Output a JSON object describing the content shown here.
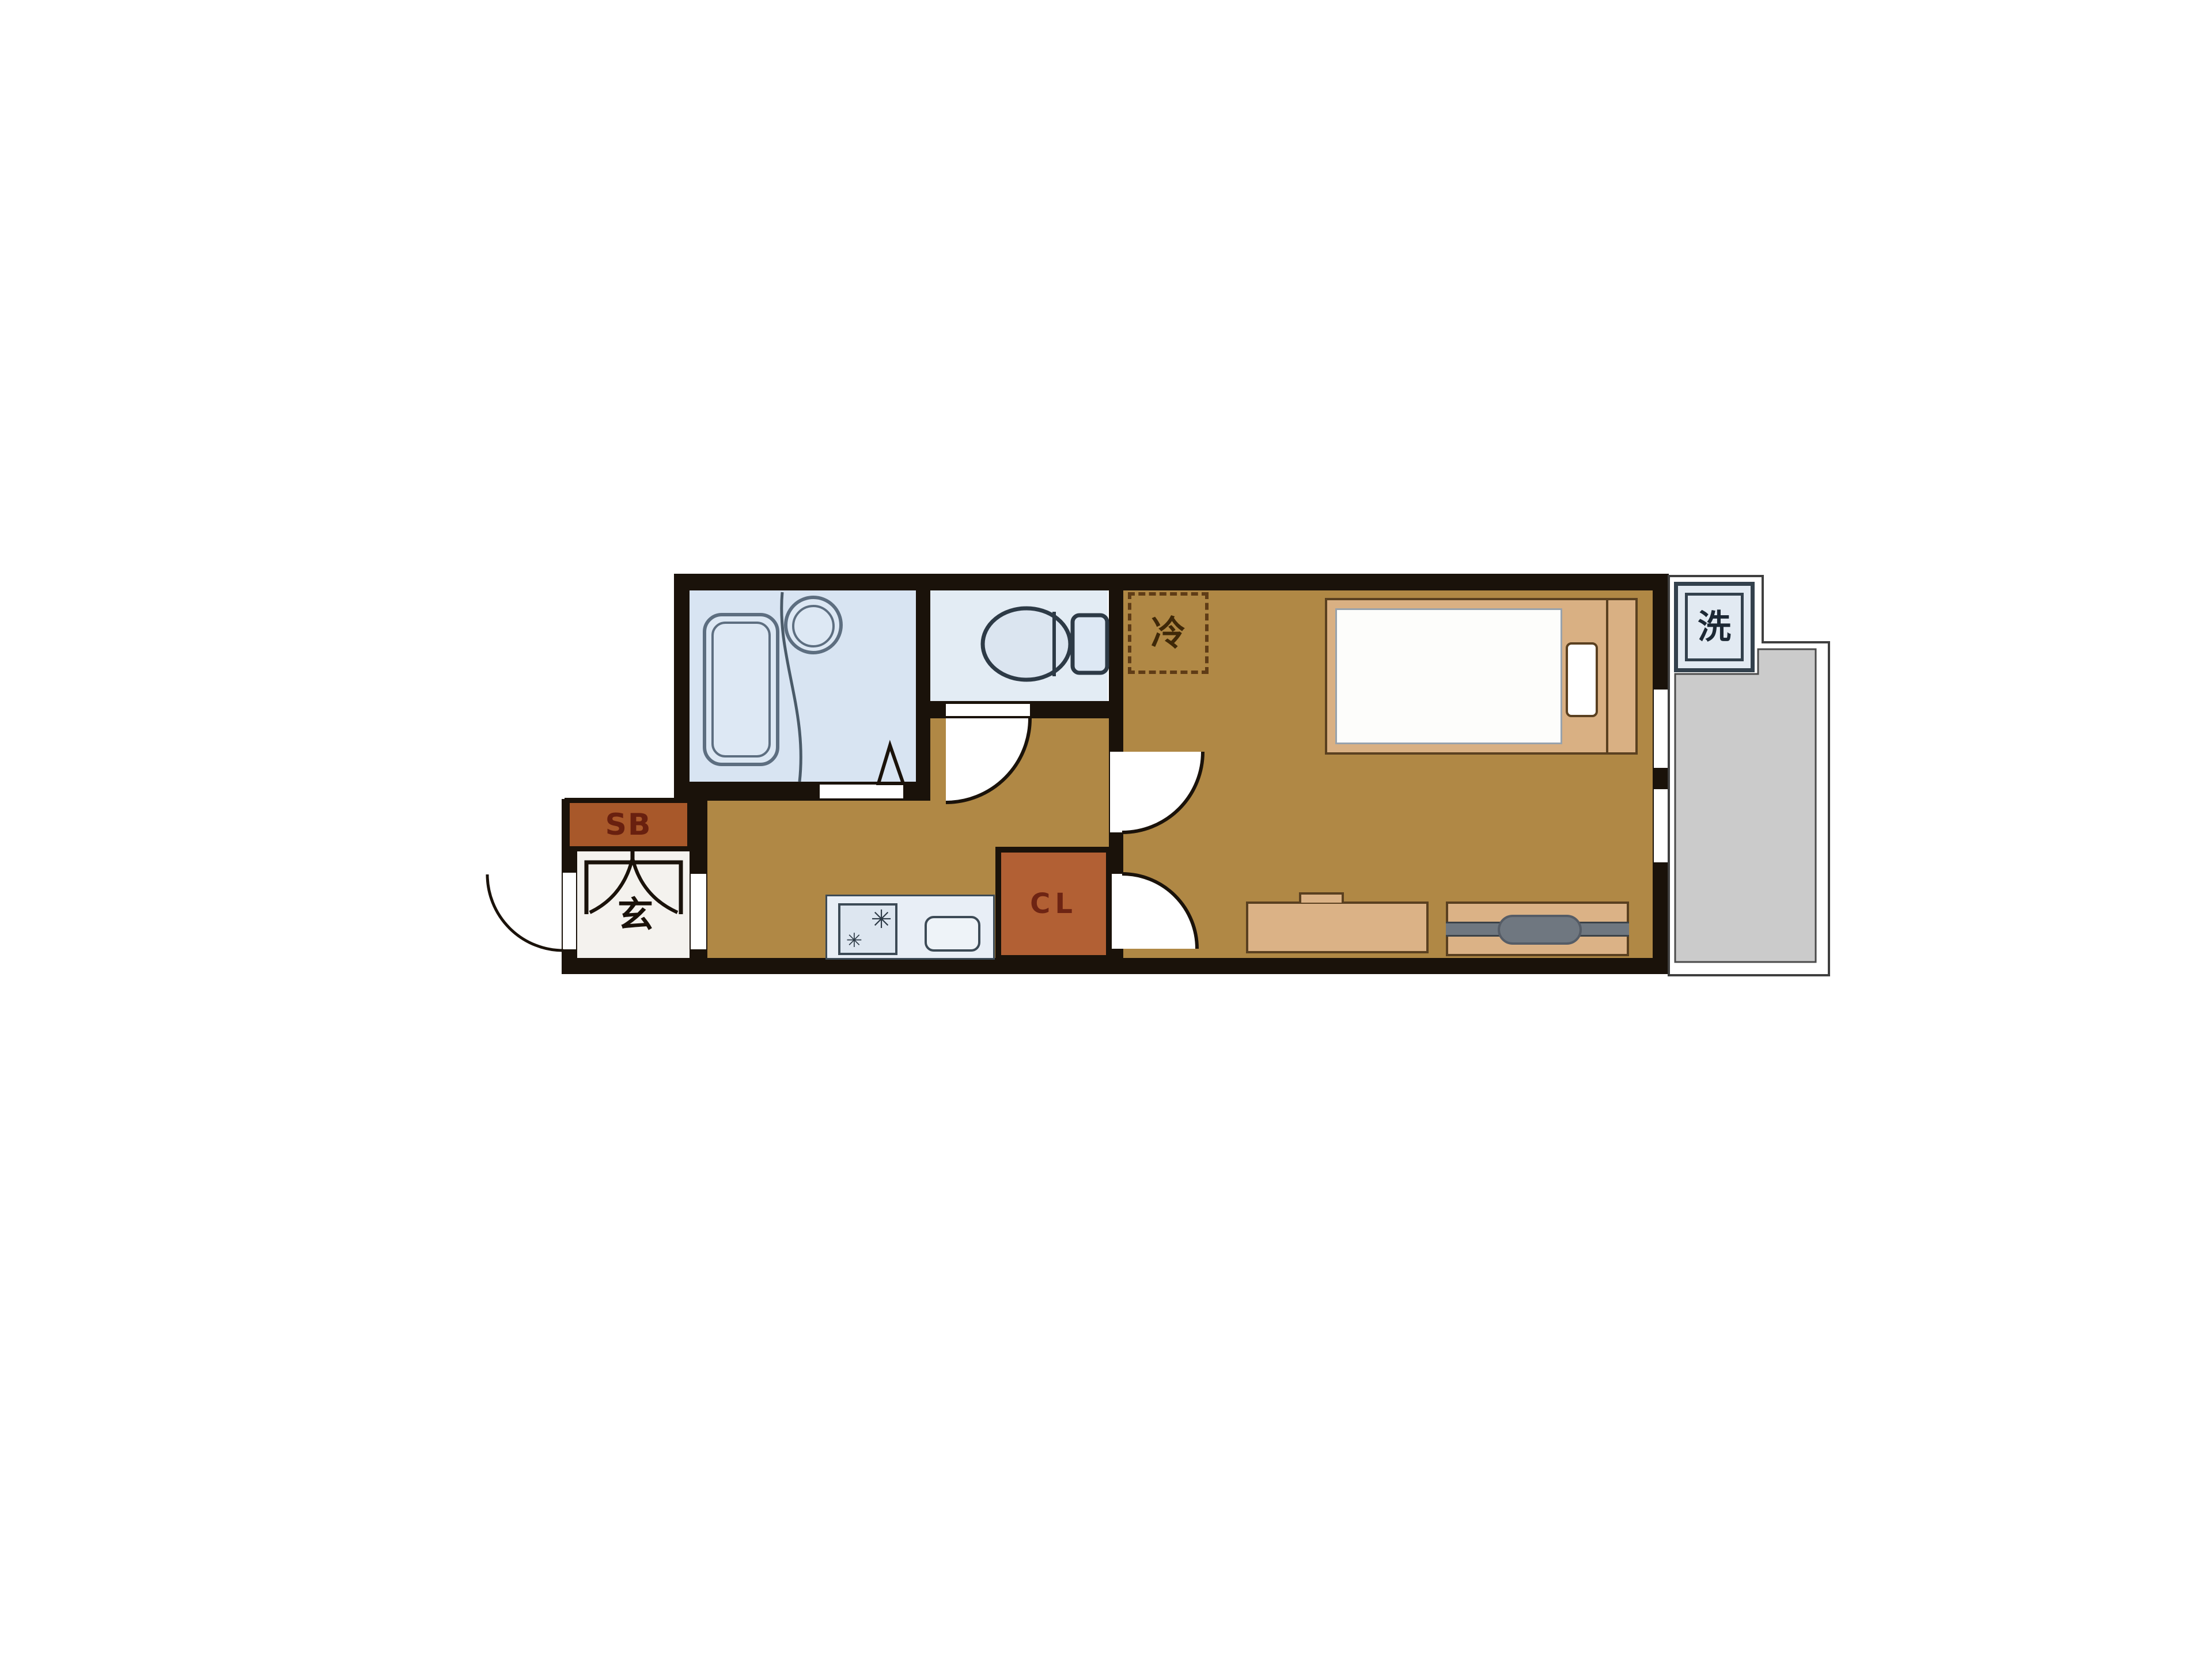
{
  "plan": {
    "type": "japanese-apartment-floorplan-1K",
    "labels": {
      "shoe_box": "SB",
      "entrance": "玄",
      "closet": "CL",
      "refrigerator": "冷",
      "washing_machine": "洗"
    },
    "icons": {
      "stove_burner_large": "✳",
      "stove_burner_small": "✳"
    },
    "colors": {
      "wall": "#1a120a",
      "floor_ochre": "#b08845",
      "bathroom_blue": "#d8e4f2",
      "toilet_blue": "#e3ecf4",
      "counter_blue": "#e8eef6",
      "genkan_white": "#f4f2ee",
      "balcony_gray": "#cbcbcb",
      "balcony_outline": "#3f3f3f",
      "wood_tan": "#d9b083",
      "wood_light": "#dbb286",
      "sb_fill": "#a8582a",
      "cl_fill": "#b26034",
      "label_dark_red": "#69200f",
      "fixture_outline": "#45535f",
      "tv_gray": "#6f7780",
      "dash_brown": "#5f3c16",
      "kanji_brown": "#3f2808"
    }
  }
}
